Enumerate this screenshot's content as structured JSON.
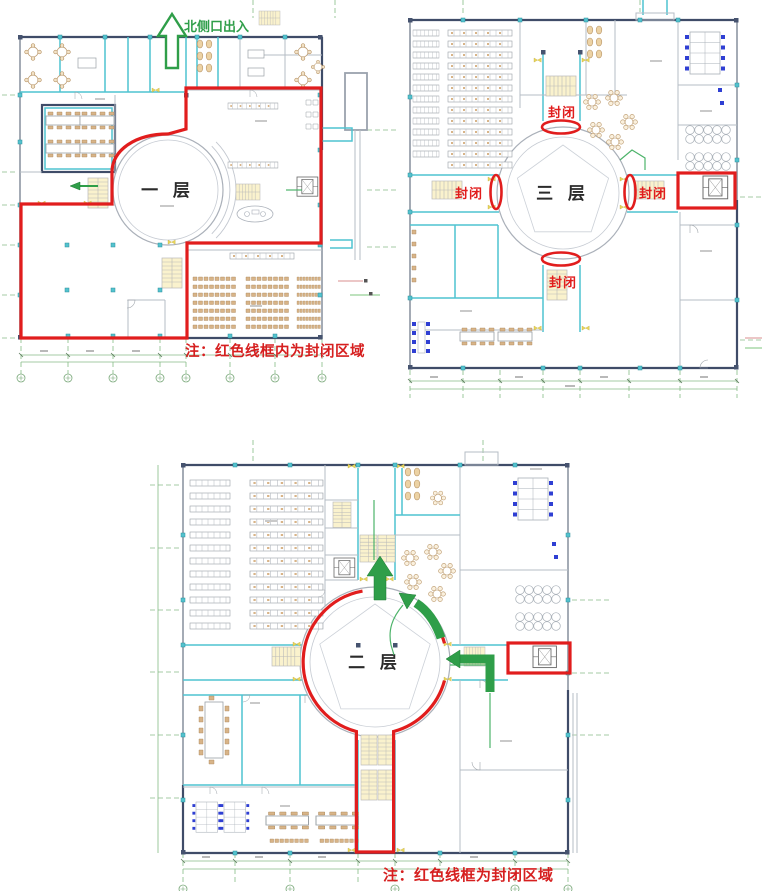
{
  "floor1": {
    "label": "一 层",
    "entrance_label": "北侧口出入",
    "note": "注：红色线框内为封闭区域"
  },
  "floor3": {
    "label": "三 层",
    "closed_top": "封闭",
    "closed_left": "封闭",
    "closed_right": "封闭",
    "closed_bottom": "封闭"
  },
  "floor2": {
    "label": "二 层",
    "note": "注：红色线框为封闭区域"
  },
  "colors": {
    "annotation_red": "#e11d1d",
    "note_red": "#d61f1f",
    "arrow_green": "#2f9e49",
    "grid_green": "#86bb86",
    "wall_navy": "#3f4c68",
    "wall_cyan": "#4fc3d1",
    "wall_gray": "#9aa2ad",
    "furniture_tan": "#d8b488",
    "chair_blue": "#2f3fd3",
    "stair_yellow": "#faf2cd"
  }
}
